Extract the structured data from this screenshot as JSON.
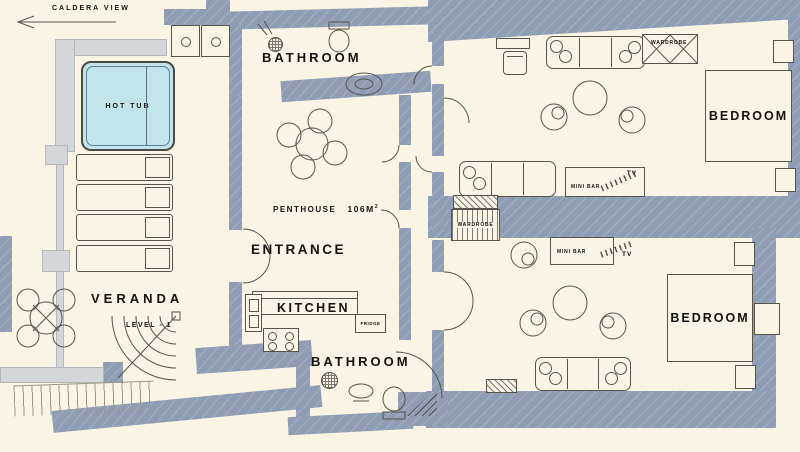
{
  "plan_type": "penthouse floor plan",
  "colors": {
    "background": "#f9f4e4",
    "wall": "#8e9cb4",
    "wall_light": "#d4d7da",
    "hot_tub_water": "#c2e4ec",
    "line": "#57544b",
    "text": "#14120c"
  },
  "labels": {
    "caldera_view": "CALDERA VIEW",
    "hot_tub": "HOT TUB",
    "bathroom_top": "BATHROOM",
    "penthouse": "PENTHOUSE",
    "area": "106M",
    "area_sup": "2",
    "entrance": "ENTRANCE",
    "kitchen": "KITCHEN",
    "fridge": "FRIDGE",
    "bathroom_bottom": "BATHROOM",
    "veranda": "VERANDA",
    "level": "LEVEL - 1",
    "bedroom_top": "BEDROOM",
    "bedroom_bottom": "BEDROOM",
    "wardrobe_top": "WARDROBE",
    "wardrobe_mid": "WARDROBE",
    "mini_bar_top": "MINI BAR",
    "tv_top": "TV",
    "mini_bar_bottom": "MINI BAR",
    "tv_bottom": "TV"
  }
}
